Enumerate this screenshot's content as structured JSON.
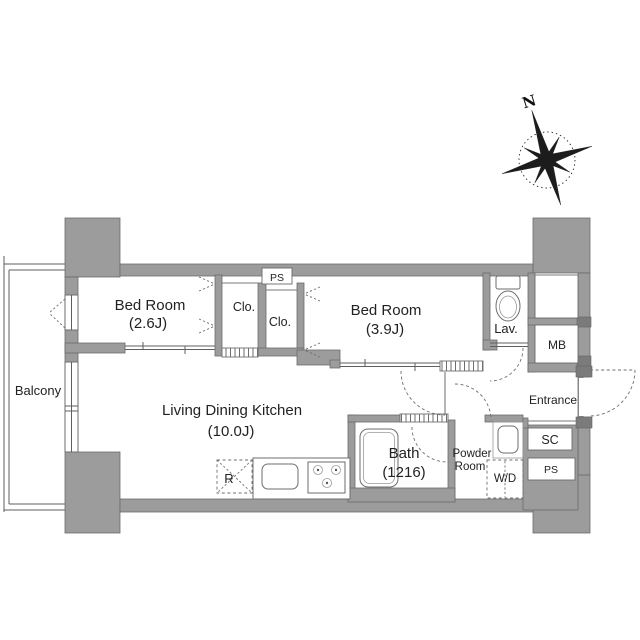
{
  "colors": {
    "wall": "#9c9c9c",
    "wall_edge": "#6b6b6b",
    "anchor_dark": "#7b7b7b",
    "line": "#5f5f5f",
    "text": "#222222",
    "background": "#ffffff"
  },
  "compass": {
    "north_label": "N"
  },
  "labels": {
    "balcony": "Balcony",
    "bedroom_small_name": "Bed Room",
    "bedroom_small_size": "(2.6J)",
    "bedroom_large_name": "Bed Room",
    "bedroom_large_size": "(3.9J)",
    "ldk_name": "Living Dining Kitchen",
    "ldk_size": "(10.0J)",
    "bath_name": "Bath",
    "bath_size": "(1216)",
    "powder_line1": "Powder",
    "powder_line2": "Room",
    "washer_dryer": "W/D",
    "lavatory": "Lav.",
    "meter_box": "MB",
    "entrance": "Entrance",
    "shoe_closet": "SC",
    "pipe_space_upper": "PS",
    "pipe_space_lower": "PS",
    "closet_left": "Clo.",
    "closet_right": "Clo.",
    "refrigerator": "R"
  }
}
